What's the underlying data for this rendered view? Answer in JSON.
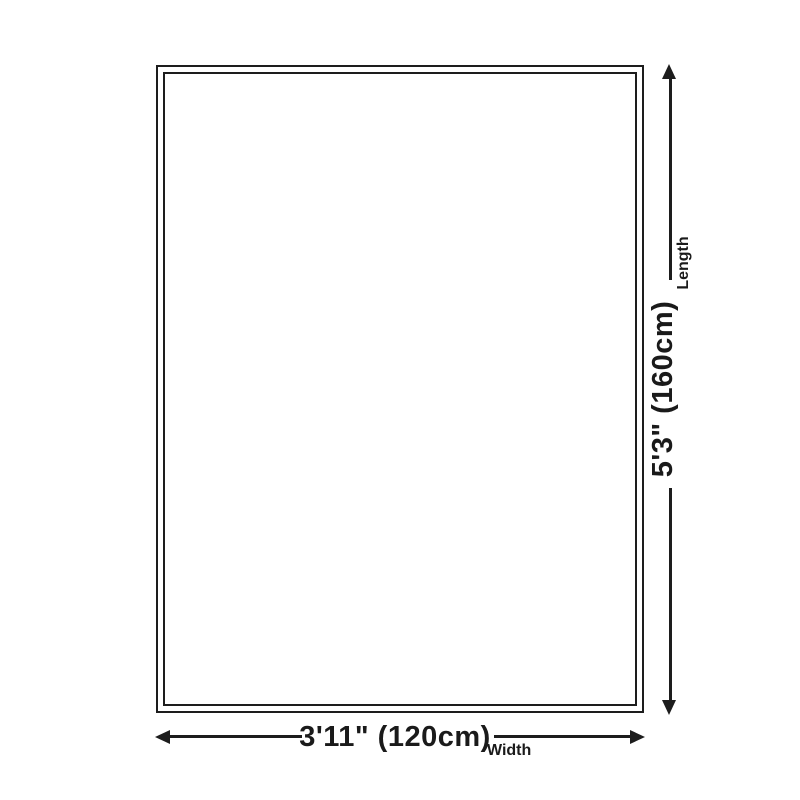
{
  "diagram": {
    "kind": "product-size-diagram",
    "background_color": "#ffffff",
    "outline_color": "#1d1d1d",
    "text_color": "#1a1a1a",
    "length": {
      "value": "5'3\" (160cm)",
      "label": "Length"
    },
    "width": {
      "value": "3'11\" (120cm)",
      "label": "Width"
    }
  }
}
